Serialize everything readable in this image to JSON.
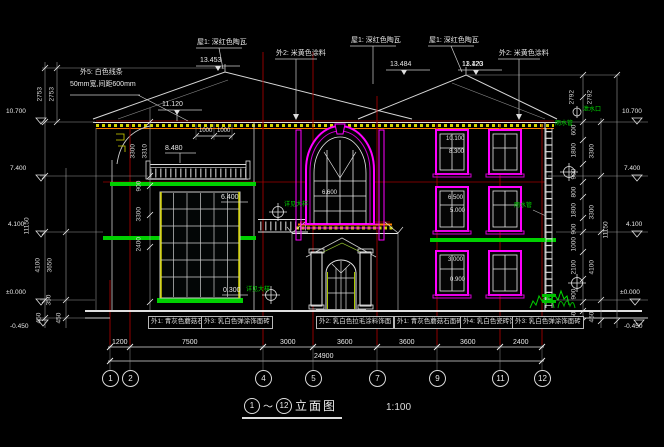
{
  "colors": {
    "background": "#000000",
    "line_white": "#e8e8e8",
    "grid_red": "#a00000",
    "window_magenta": "#ff00ff",
    "detail_green": "#00d000",
    "cornice_yellow": "#d4d400",
    "canopy_orange": "#ff7f00"
  },
  "top_annotations": {
    "ext5": "外5: 白色线条",
    "ext5b": "50mm宽,间距600mm",
    "roof1a": "屋1: 深红色陶瓦",
    "roof1b": "屋1: 深红色陶瓦",
    "roof1c": "屋1: 深红色陶瓦",
    "ext2a": "外2: 米黄色涂料",
    "ext2b": "外2: 米黄色涂料"
  },
  "roof_dims": {
    "r1": "13.453",
    "r2": "13.484",
    "r3": "13.423",
    "mid": "11.120",
    "b1": "1000",
    "b2": "1000"
  },
  "elevations": {
    "left": [
      "10.700",
      "7.400",
      "4.100",
      "±0.000",
      "-0.450"
    ],
    "right": [
      "10.700",
      "7.400",
      "4.100",
      "±0.000",
      "-0.450"
    ]
  },
  "facade_labels": {
    "rail": "8.480",
    "curtain_top": "6.400",
    "curtain_btm": "0.300",
    "arch": "6.600",
    "f3_top": "10.100",
    "f3_sill": "8.300",
    "f2_top": "6.500",
    "f2_sill": "5.000",
    "f1_top": "3.000",
    "f1_sill": "0.900"
  },
  "green_labels": [
    "泄水口",
    "雨水管",
    "雨水管",
    "详见大样",
    "详见大样"
  ],
  "ldims": [
    "2753",
    "2753",
    "3300",
    "3310",
    "900",
    "3300",
    "2400",
    "11150",
    "4100",
    "3650",
    "350",
    "450",
    "450"
  ],
  "rdims2": [
    "2792",
    "2792",
    "600",
    "1800",
    "900",
    "800",
    "1800",
    "900",
    "1000",
    "2100",
    "900",
    "450",
    "3300",
    "3300",
    "4100",
    "450",
    "11150"
  ],
  "bottom": {
    "dims": [
      "1200",
      "7500",
      "3000",
      "3600",
      "3600",
      "3600",
      "2400"
    ],
    "total": "24900"
  },
  "bubbles": [
    "1",
    "2",
    "4",
    "5",
    "7",
    "9",
    "11",
    "12"
  ],
  "notes": [
    "外1: 青灰色蘑菇石面砖",
    "外3: 乳白色弹涂饰面砖",
    "外2: 乳白色拉毛涂料饰面",
    "外1: 青灰色蘑菇石面砖",
    "外4: 乳白色瓷砖饰面砖",
    "外3: 乳白色弹涂饰面砖"
  ],
  "title": {
    "bubble_start": "1",
    "tilde": "～",
    "bubble_end": "12",
    "text": "立面图",
    "scale": "1:100"
  }
}
